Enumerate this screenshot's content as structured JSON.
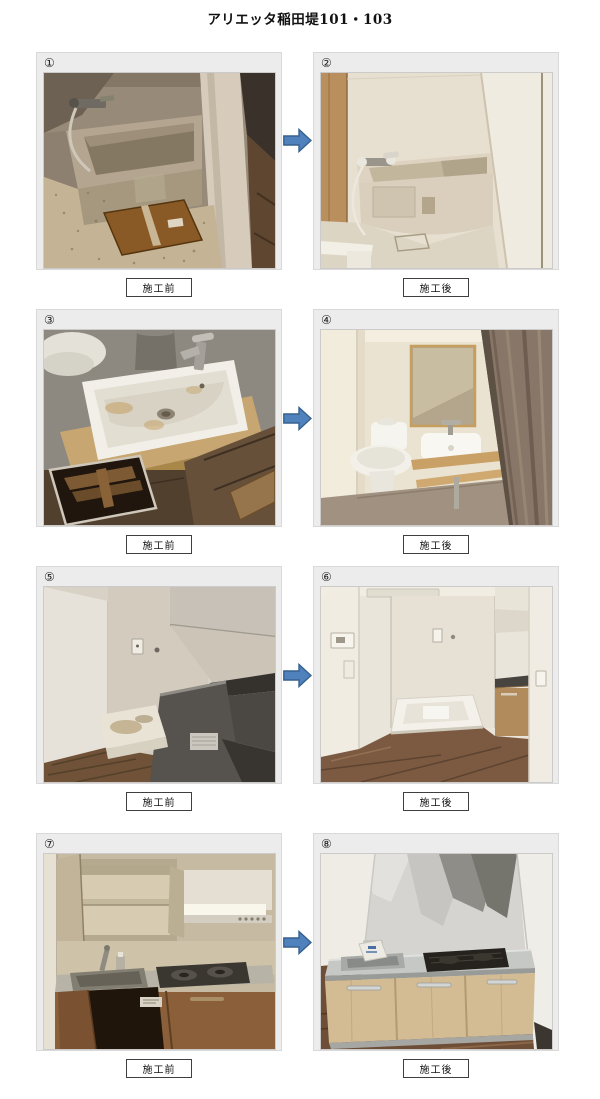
{
  "title": "アリエッタ稲田堤101・103",
  "labels": {
    "before": "施工前",
    "after": "施工後"
  },
  "colors": {
    "arrow_fill": "#4f81bd",
    "arrow_stroke": "#36618e",
    "panel_bg": "#ececec",
    "page_bg": "#ffffff"
  },
  "rows": [
    {
      "before_num": "①",
      "after_num": "②",
      "before_desc": "bathroom bathtub before renovation, dirty",
      "after_desc": "bathroom bathtub after renovation, clean"
    },
    {
      "before_num": "③",
      "after_num": "④",
      "before_desc": "washbasin before renovation, removed and dirty with open floor hatch",
      "after_desc": "restroom after renovation with mirror, toilet and new washbasin"
    },
    {
      "before_num": "⑤",
      "after_num": "⑥",
      "before_desc": "laundry corner before renovation",
      "after_desc": "laundry corner after renovation with new washer pan and flooring"
    },
    {
      "before_num": "⑦",
      "after_num": "⑧",
      "before_desc": "old kitchen before renovation with open cabinets",
      "after_desc": "new kitchen after renovation with wood cabinets and black cooktop"
    }
  ]
}
